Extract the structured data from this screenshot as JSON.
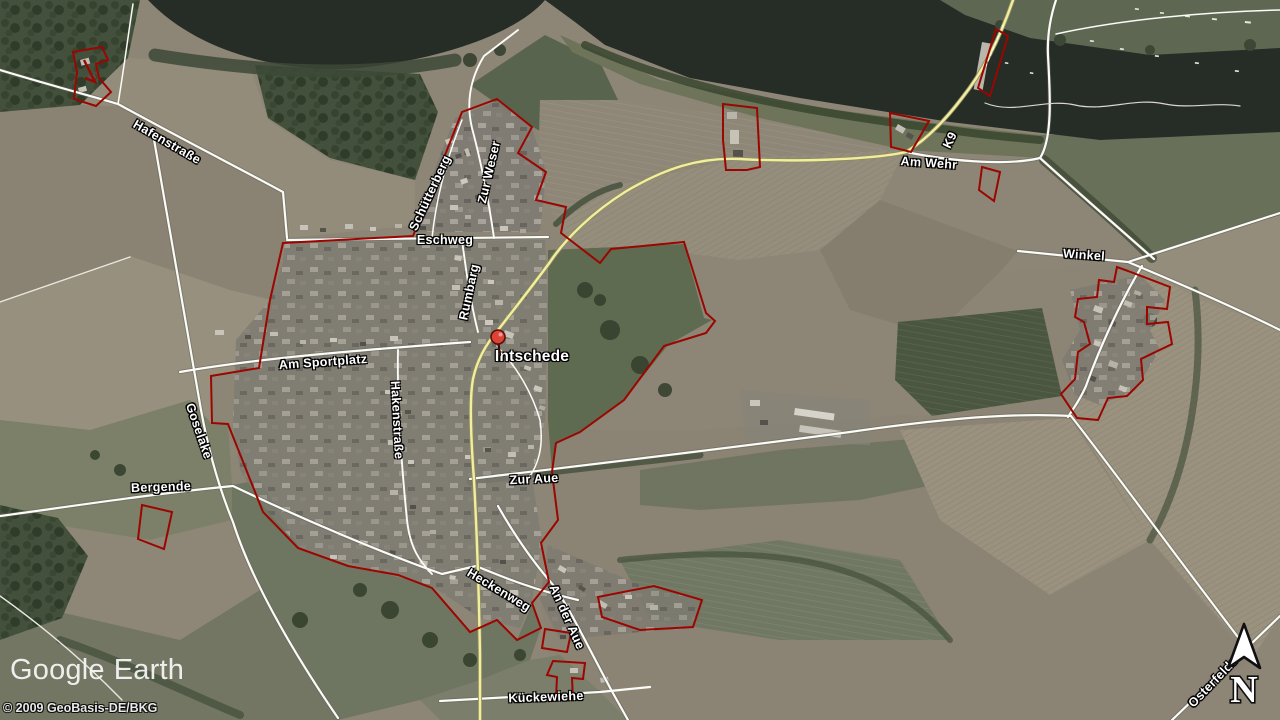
{
  "app": {
    "brand": "Google",
    "product": "Earth"
  },
  "attribution": "© 2009 GeoBasis-DE/BKG",
  "marker": {
    "label": "Intschede"
  },
  "roads": {
    "hafenstrasse": "Hafenstraße",
    "schuetterberg": "Schütterberg",
    "zur_weser": "Zur Weser",
    "eschweg": "Eschweg",
    "rumbarg": "Rumbarg",
    "am_sportplatz": "Am Sportplatz",
    "goselake": "Goselake",
    "hakenstrasse": "Hakenstraße",
    "bergende": "Bergende",
    "zur_aue": "Zur Aue",
    "heckenweg": "Heckenweg",
    "an_der_aue": "An der Aue",
    "kueckewiehe": "Kückewiehe",
    "am_wehr": "Am Wehr",
    "k9": "K9",
    "winkel": "Winkel",
    "osterfelde": "Osterfelde"
  },
  "compass": {
    "north": "N"
  },
  "colors": {
    "parcel_boundary": "#9b0600",
    "road_primary_yellow": "#f1eea0",
    "road_secondary_white": "#fbfbf7",
    "water_dark": "#262c26",
    "label_text": "#ffffff",
    "marker_red": "#dd4237"
  }
}
